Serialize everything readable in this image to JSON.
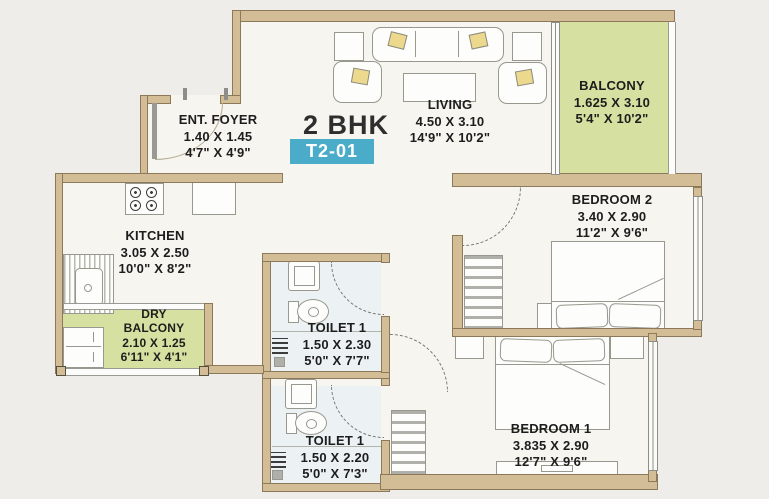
{
  "title": {
    "type": "2 BHK",
    "unit": "T2-01"
  },
  "rooms": {
    "living": {
      "name": "LIVING",
      "dim_m": "4.50 X 3.10",
      "dim_ft": "14'9\" X 10'2\""
    },
    "balcony": {
      "name": "BALCONY",
      "dim_m": "1.625 X 3.10",
      "dim_ft": "5'4\" X 10'2\""
    },
    "bedroom2": {
      "name": "BEDROOM 2",
      "dim_m": "3.40 X 2.90",
      "dim_ft": "11'2\" X 9'6\""
    },
    "bedroom1": {
      "name": "BEDROOM 1",
      "dim_m": "3.835 X 2.90",
      "dim_ft": "12'7\" X 9'6\""
    },
    "kitchen": {
      "name": "KITCHEN",
      "dim_m": "3.05 X 2.50",
      "dim_ft": "10'0\" X 8'2\""
    },
    "dry_balcony": {
      "name_line1": "DRY",
      "name_line2": "BALCONY",
      "dim_m": "2.10 X 1.25",
      "dim_ft": "6'11\" X 4'1\""
    },
    "ent_foyer": {
      "name": "ENT. FOYER",
      "dim_m": "1.40 X 1.45",
      "dim_ft": "4'7\" X 4'9\""
    },
    "toilet_upper": {
      "name": "TOILET 1",
      "dim_m": "1.50 X 2.30",
      "dim_ft": "5'0\" X 7'7\""
    },
    "toilet_lower": {
      "name": "TOILET 1",
      "dim_m": "1.50 X 2.20",
      "dim_ft": "5'0\" X 7'3\""
    }
  },
  "colors": {
    "wall": "#d3bd96",
    "balcony_green": "#d6e0a0",
    "toilet_floor": "#ecf2f4",
    "room_floor": "#f6f5f0",
    "badge_teal": "#4aacc8",
    "page_background": "#eeedea"
  }
}
